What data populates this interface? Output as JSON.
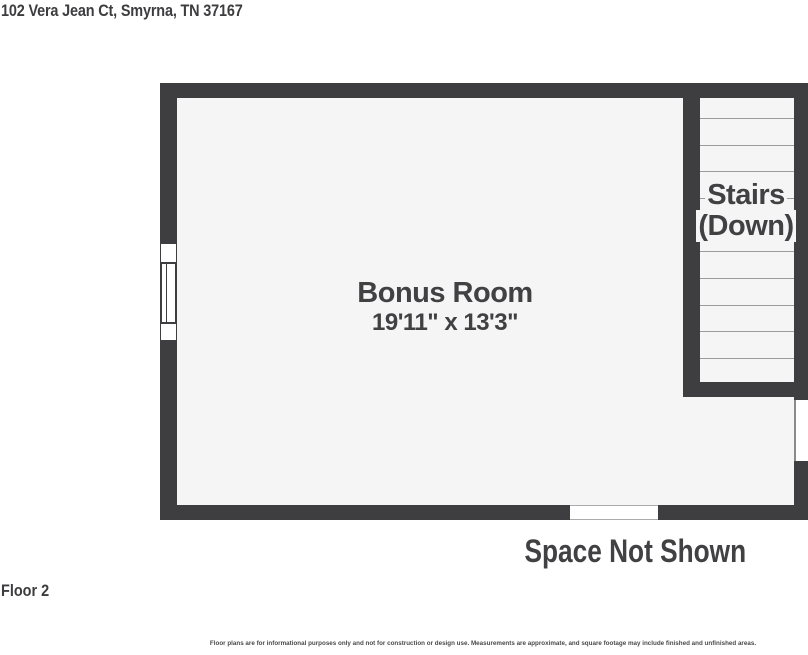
{
  "header": {
    "address": "102 Vera Jean Ct, Smyrna, TN 37167"
  },
  "floorplan": {
    "room": {
      "name": "Bonus Room",
      "dimensions": "19'11\" x 13'3\""
    },
    "stairs": {
      "line1": "Stairs",
      "line2": "(Down)"
    },
    "annotations": {
      "space_not_shown": "Space Not Shown"
    }
  },
  "footer": {
    "floor_label": "Floor 2",
    "disclaimer": "Floor plans are for informational purposes only and not for construction or design use. Measurements are approximate, and square footage may include finished and unfinished areas."
  },
  "colors": {
    "wall": "#3e3e40",
    "room_fill": "#f5f5f5",
    "text": "#414042",
    "stair_tread_line": "#9b9b9b"
  }
}
